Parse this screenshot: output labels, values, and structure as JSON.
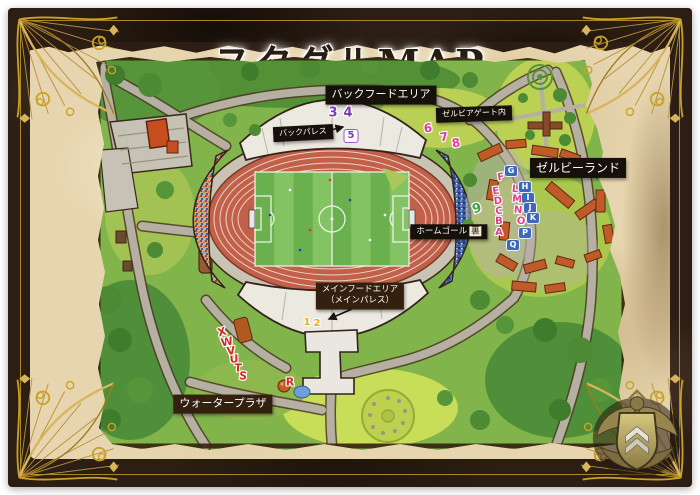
{
  "title": "スタグルMAP",
  "labels": [
    {
      "id": "back-food-area",
      "lines": [
        "バックフードエリア"
      ],
      "x": 381,
      "y": 95,
      "fs": 11,
      "style": "black"
    },
    {
      "id": "back-palace",
      "lines": [
        "バックパレス"
      ],
      "x": 303,
      "y": 133,
      "fs": 8,
      "style": "black",
      "r": -3
    },
    {
      "id": "zelvia-gate",
      "lines": [
        "ゼルビアゲート内"
      ],
      "x": 474,
      "y": 114,
      "fs": 8,
      "style": "black",
      "r": -2
    },
    {
      "id": "zelvy-land",
      "lines": [
        "ゼルビーランド"
      ],
      "x": 578,
      "y": 168,
      "fs": 12,
      "style": "black"
    },
    {
      "id": "home-goal-ura",
      "lines": [
        "ホームゴール"
      ],
      "suffix": "裏",
      "x": 449,
      "y": 232,
      "fs": 8.5,
      "style": "black"
    },
    {
      "id": "main-food-area",
      "lines": [
        "メインフードエリア",
        "（メインパレス）"
      ],
      "x": 360,
      "y": 296,
      "fs": 8.5,
      "style": "brown"
    },
    {
      "id": "water-plaza",
      "lines": [
        "ウォータープラザ"
      ],
      "x": 223,
      "y": 404,
      "fs": 11,
      "style": "brown"
    }
  ],
  "markers": [
    {
      "label": "1",
      "style": "yellow",
      "x": 307,
      "y": 323,
      "fs": 10
    },
    {
      "label": "2",
      "style": "yellow",
      "x": 317,
      "y": 324,
      "fs": 10
    },
    {
      "label": "3",
      "style": "purple",
      "x": 333,
      "y": 113,
      "fs": 13
    },
    {
      "label": "4",
      "style": "purple",
      "x": 348,
      "y": 113,
      "fs": 13
    },
    {
      "label": "5",
      "style": "whitebox",
      "x": 351,
      "y": 136,
      "fs": 10
    },
    {
      "label": "6",
      "style": "pink",
      "x": 428,
      "y": 128,
      "fs": 12,
      "r": -5
    },
    {
      "label": "7",
      "style": "pink",
      "x": 444,
      "y": 137,
      "fs": 12,
      "r": -8
    },
    {
      "label": "8",
      "style": "pink",
      "x": 456,
      "y": 143,
      "fs": 12,
      "r": -10
    },
    {
      "label": "9",
      "style": "green",
      "x": 477,
      "y": 209,
      "fs": 13,
      "r": -15
    },
    {
      "label": "F",
      "style": "pink",
      "x": 501,
      "y": 178,
      "fs": 10,
      "r": -10
    },
    {
      "label": "E",
      "style": "pink",
      "x": 496,
      "y": 192,
      "fs": 10,
      "r": -8
    },
    {
      "label": "D",
      "style": "pink",
      "x": 498,
      "y": 202,
      "fs": 10,
      "r": -6
    },
    {
      "label": "C",
      "style": "pink",
      "x": 499,
      "y": 212,
      "fs": 10,
      "r": -4
    },
    {
      "label": "B",
      "style": "pink",
      "x": 499,
      "y": 222,
      "fs": 10,
      "r": -2
    },
    {
      "label": "A",
      "style": "pink",
      "x": 499,
      "y": 233,
      "fs": 10
    },
    {
      "label": "L",
      "style": "pink",
      "x": 515,
      "y": 190,
      "fs": 10,
      "r": 6
    },
    {
      "label": "M",
      "style": "pink",
      "x": 517,
      "y": 200,
      "fs": 10,
      "r": 6
    },
    {
      "label": "N",
      "style": "pink",
      "x": 518,
      "y": 211,
      "fs": 10,
      "r": 6
    },
    {
      "label": "O",
      "style": "pink",
      "x": 521,
      "y": 222,
      "fs": 10,
      "r": 6
    },
    {
      "label": "G",
      "style": "bluebox",
      "x": 511,
      "y": 171,
      "fs": 8
    },
    {
      "label": "H",
      "style": "bluebox",
      "x": 525,
      "y": 187,
      "fs": 8
    },
    {
      "label": "I",
      "style": "bluebox",
      "x": 528,
      "y": 198,
      "fs": 8
    },
    {
      "label": "J",
      "style": "bluebox",
      "x": 530,
      "y": 208,
      "fs": 8
    },
    {
      "label": "K",
      "style": "bluebox",
      "x": 533,
      "y": 218,
      "fs": 8
    },
    {
      "label": "P",
      "style": "bluebox",
      "x": 525,
      "y": 233,
      "fs": 8
    },
    {
      "label": "Q",
      "style": "bluebox",
      "x": 513,
      "y": 245,
      "fs": 8
    },
    {
      "label": "R",
      "style": "red",
      "x": 290,
      "y": 382,
      "fs": 11
    },
    {
      "label": "S",
      "style": "red",
      "x": 243,
      "y": 376,
      "fs": 11,
      "r": 8
    },
    {
      "label": "T",
      "style": "red",
      "x": 238,
      "y": 368,
      "fs": 11,
      "r": 3
    },
    {
      "label": "U",
      "style": "red",
      "x": 234,
      "y": 359,
      "fs": 11,
      "r": -3
    },
    {
      "label": "V",
      "style": "red",
      "x": 231,
      "y": 351,
      "fs": 11,
      "r": -8
    },
    {
      "label": "W",
      "style": "red",
      "x": 227,
      "y": 342,
      "fs": 11,
      "r": -12
    },
    {
      "label": "X",
      "style": "red",
      "x": 222,
      "y": 332,
      "fs": 11,
      "r": -16
    }
  ],
  "colors": {
    "frame_brown": "#2c1e14",
    "parchment": "#e6d5ae",
    "gold_accent": "#c9a227",
    "map_green": "#82b44c",
    "track_terracotta": "#c2604a",
    "pitch_green": "#6ab04f",
    "label_black": "#16100a",
    "label_brown": "#33200f",
    "marker_pink": "#e23c8e",
    "marker_purple": "#7d3bb5",
    "marker_yellow": "#f0a81f",
    "marker_green": "#43a047",
    "marker_red": "#d7281f",
    "marker_blue_box": "#3e68b8"
  }
}
